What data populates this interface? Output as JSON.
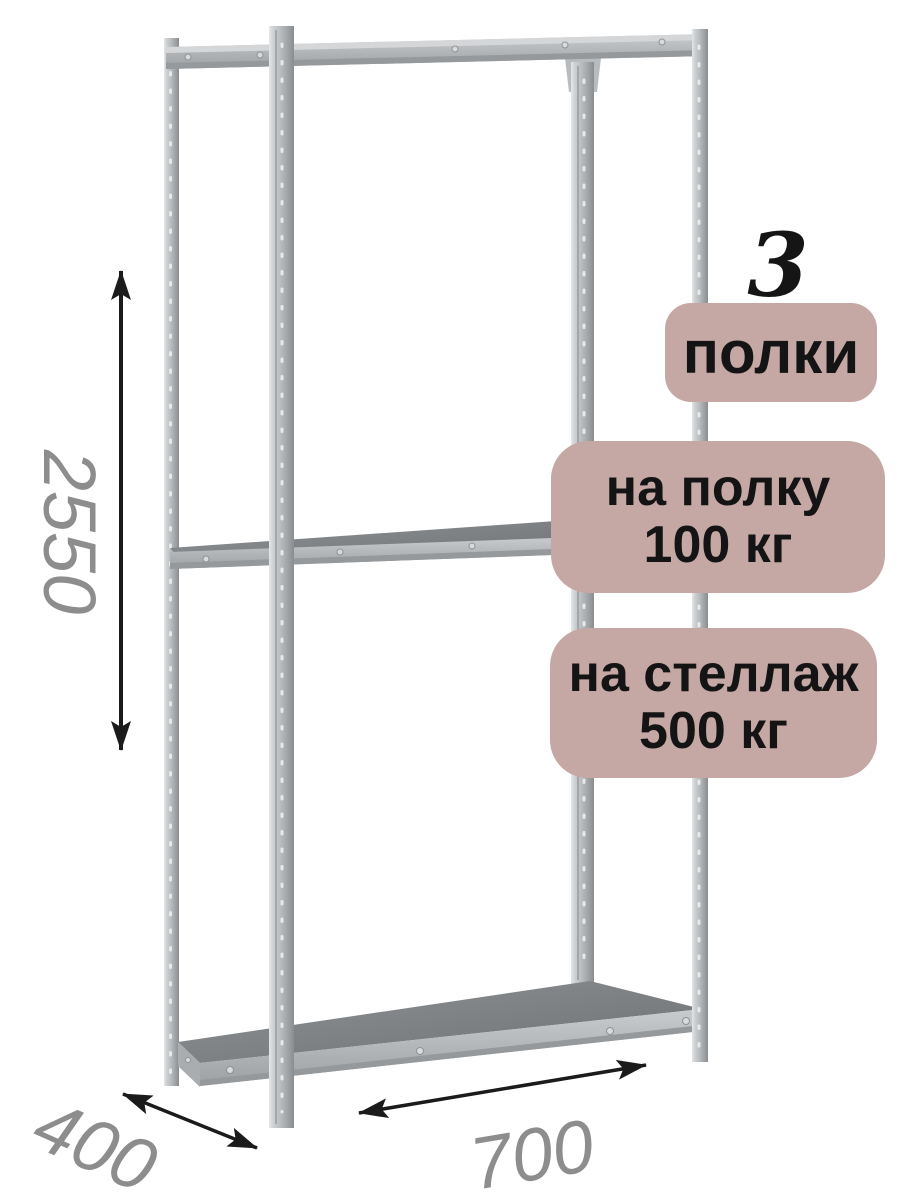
{
  "product_annotation": {
    "shelf_count": {
      "number": "3",
      "label": "полки"
    },
    "load_per_shelf": {
      "line1": "на полку",
      "line2": "100 кг"
    },
    "load_total": {
      "line1": "на стеллаж",
      "line2": "500 кг"
    },
    "dimensions": {
      "height": "2550",
      "depth": "400",
      "width": "700"
    }
  },
  "illustration": {
    "subject": "metal-boltless-shelving-rack",
    "shelves_visible": 3
  },
  "colors": {
    "background": "#ffffff",
    "badge_bg": "#c5a7a4",
    "badge_text": "#141414",
    "count_text": "#151515",
    "dimension_text": "#8d8d8d",
    "arrow": "#1b1b1b",
    "metal_light": "#d9dbdd",
    "metal_mid": "#b4b7ba",
    "metal_dark": "#8f9295",
    "shelf_surface": "#7c7f82",
    "shelf_edge": "#b2b5b8"
  }
}
